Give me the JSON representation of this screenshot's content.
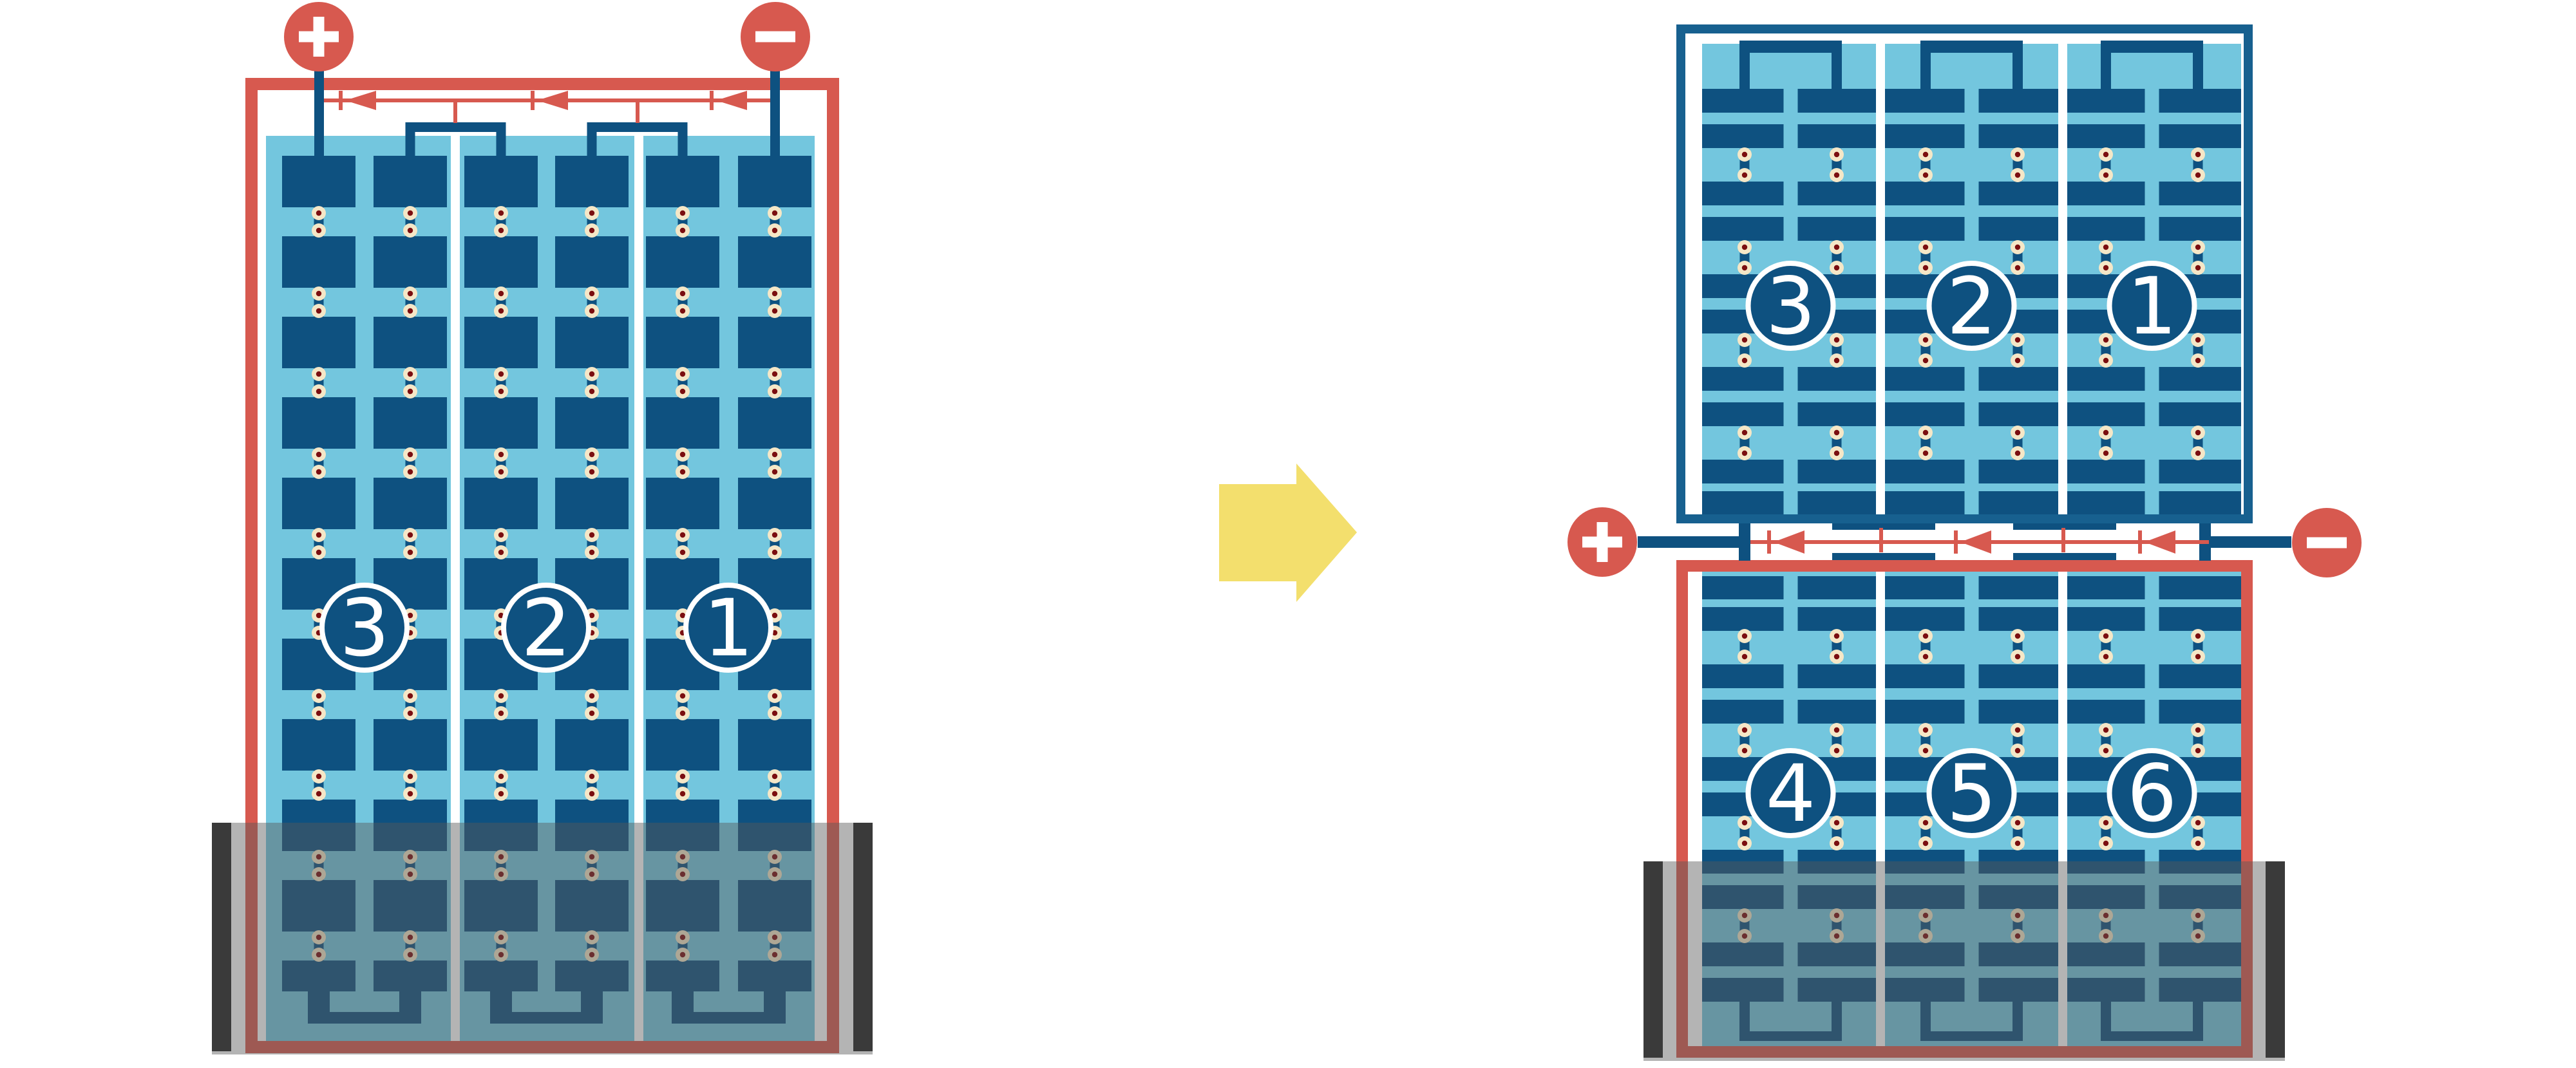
{
  "left_battery": {
    "cells": [
      "3",
      "2",
      "1"
    ],
    "positive": "+",
    "negative": "−",
    "diodes": 3
  },
  "right_top_battery": {
    "cells": [
      "3",
      "2",
      "1"
    ]
  },
  "right_bottom_battery": {
    "cells": [
      "4",
      "5",
      "6"
    ]
  },
  "junction": {
    "positive": "+",
    "negative": "−",
    "diodes": 3
  },
  "arrow": {
    "direction": "right"
  },
  "colors": {
    "red": "#D7594F",
    "navy": "#0E5180",
    "case_blue": "#17608F",
    "light_blue": "#73C6DE",
    "bead": "#F5E7C7",
    "bead_core": "#7B0E10",
    "white": "#FFFFFF",
    "yellow": "#F3DF6D",
    "gray_bar": "#3A3A3A",
    "overlay": "rgba(88,88,88,0.45)"
  }
}
